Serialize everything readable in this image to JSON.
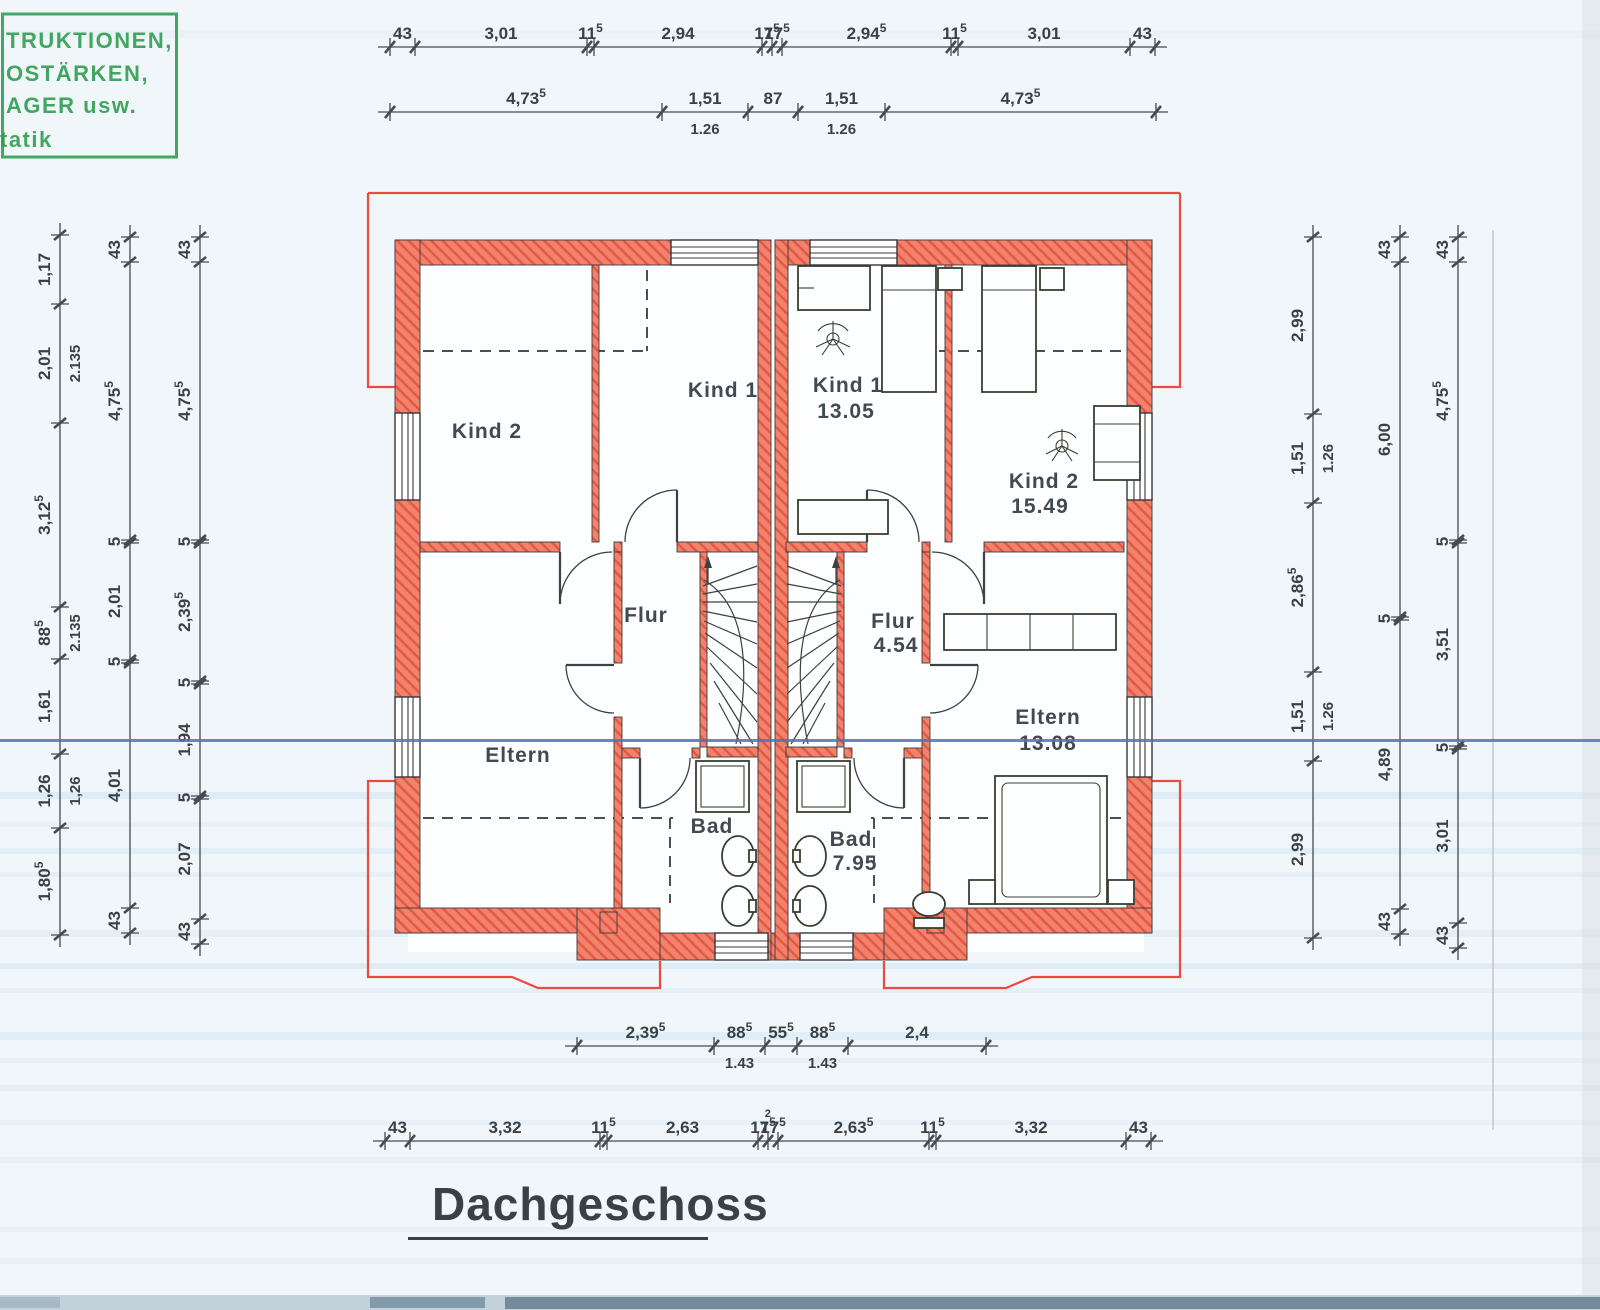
{
  "title": {
    "text": "Dachgeschoss"
  },
  "stamp": {
    "color": "#2f9e50",
    "lines": [
      "TRUKTIONEN,",
      "OSTÄRKEN,",
      "AGER usw.",
      "tatik"
    ]
  },
  "rooms": {
    "left": {
      "kind2": "Kind 2",
      "kind1": "Kind 1",
      "flur": "Flur",
      "eltern": "Eltern",
      "bad": "Bad"
    },
    "right": {
      "kind1": "Kind 1",
      "kind1_area": "13.05",
      "kind2": "Kind 2",
      "kind2_area": "15.49",
      "flur": "Flur",
      "flur_area": "4.54",
      "eltern": "Eltern",
      "eltern_area": "13.08",
      "bad": "Bad",
      "bad_area": "7.95"
    }
  },
  "dimensions": {
    "chains": [
      {
        "id": "top-upper",
        "dir": "h",
        "x": 390,
        "y": 47,
        "segments": [
          {
            "len": 25,
            "t": "43"
          },
          {
            "len": 172,
            "t": "3,01"
          },
          {
            "len": 7,
            "t": "11",
            "sup": "5"
          },
          {
            "len": 168,
            "t": "2,94"
          },
          {
            "len": 10,
            "t": "17",
            "sup": "5"
          },
          {
            "len": 10,
            "t": "17",
            "sup": "5"
          },
          {
            "len": 169,
            "t": "2,94",
            "sup": "5"
          },
          {
            "len": 7,
            "t": "11",
            "sup": "5"
          },
          {
            "len": 172,
            "t": "3,01"
          },
          {
            "len": 25,
            "t": "43"
          }
        ]
      },
      {
        "id": "top-lower",
        "dir": "h",
        "x": 390,
        "y": 112,
        "segments": [
          {
            "len": 272,
            "t": "4,73",
            "sup": "5"
          },
          {
            "len": 86,
            "t": "1,51",
            "sub": "1.26"
          },
          {
            "len": 50,
            "t": "87"
          },
          {
            "len": 87,
            "t": "1,51",
            "sub": "1.26"
          },
          {
            "len": 271,
            "t": "4,73",
            "sup": "5"
          }
        ]
      },
      {
        "id": "bottom-upper",
        "dir": "h",
        "x": 577,
        "y": 1046,
        "segments": [
          {
            "len": 137,
            "t": "2,39",
            "sup": "5"
          },
          {
            "len": 51,
            "t": "88",
            "sup": "5",
            "sub": "1.43"
          },
          {
            "len": 32,
            "t": "55",
            "sup": "5"
          },
          {
            "len": 51,
            "t": "88",
            "sup": "5",
            "sub": "1.43"
          },
          {
            "len": 138,
            "t": "2,4"
          }
        ]
      },
      {
        "id": "bottom-lower",
        "dir": "h",
        "x": 385,
        "y": 1141,
        "segments": [
          {
            "len": 25,
            "t": "43"
          },
          {
            "len": 190,
            "t": "3,32"
          },
          {
            "len": 7,
            "t": "11",
            "sup": "5"
          },
          {
            "len": 151,
            "t": "2,63"
          },
          {
            "len": 10,
            "t": "17",
            "sup": "5",
            "sup2": "2"
          },
          {
            "len": 10,
            "t": "17",
            "sup": "5"
          },
          {
            "len": 151,
            "t": "2,63",
            "sup": "5"
          },
          {
            "len": 7,
            "t": "11",
            "sup": "5"
          },
          {
            "len": 190,
            "t": "3,32"
          },
          {
            "len": 25,
            "t": "43"
          }
        ]
      },
      {
        "id": "left-outer",
        "dir": "v",
        "x": 60,
        "y": 235,
        "segments": [
          {
            "len": 69,
            "t": "1,17"
          },
          {
            "len": 119,
            "t": "2,01",
            "sub": "2.135"
          },
          {
            "len": 184,
            "t": "3,12",
            "sup": "5"
          },
          {
            "len": 52,
            "t": "88",
            "sup": "5",
            "sub": "2.135"
          },
          {
            "len": 95,
            "t": "1,61"
          },
          {
            "len": 74,
            "t": "1,26",
            "sub": "1,26"
          },
          {
            "len": 107,
            "t": "1,80",
            "sup": "5"
          }
        ]
      },
      {
        "id": "left-mid",
        "dir": "v",
        "x": 130,
        "y": 237,
        "segments": [
          {
            "len": 25,
            "t": "43"
          },
          {
            "len": 278,
            "t": "4,75",
            "sup": "5"
          },
          {
            "len": 3,
            "t": "5"
          },
          {
            "len": 117,
            "t": "2,01"
          },
          {
            "len": 3,
            "t": "5"
          },
          {
            "len": 245,
            "t": "4,01"
          },
          {
            "len": 25,
            "t": "43"
          }
        ]
      },
      {
        "id": "left-inner",
        "dir": "v",
        "x": 200,
        "y": 237,
        "segments": [
          {
            "len": 25,
            "t": "43"
          },
          {
            "len": 278,
            "t": "4,75",
            "sup": "5"
          },
          {
            "len": 3,
            "t": "5"
          },
          {
            "len": 138,
            "t": "2,39",
            "sup": "5"
          },
          {
            "len": 3,
            "t": "5"
          },
          {
            "len": 112,
            "t": "1,94"
          },
          {
            "len": 3,
            "t": "5"
          },
          {
            "len": 120,
            "t": "2,07"
          },
          {
            "len": 25,
            "t": "43"
          }
        ]
      },
      {
        "id": "right-inner",
        "dir": "v",
        "x": 1313,
        "y": 237,
        "segments": [
          {
            "len": 177,
            "t": "2,99"
          },
          {
            "len": 89,
            "t": "1,51",
            "sub": "1.26"
          },
          {
            "len": 169,
            "t": "2,86",
            "sup": "5"
          },
          {
            "len": 89,
            "t": "1,51",
            "sub": "1.26"
          },
          {
            "len": 177,
            "t": "2,99"
          }
        ]
      },
      {
        "id": "right-mid",
        "dir": "v",
        "x": 1400,
        "y": 237,
        "segments": [
          {
            "len": 25,
            "t": "43"
          },
          {
            "len": 355,
            "t": "6,00"
          },
          {
            "len": 3,
            "t": "5"
          },
          {
            "len": 289,
            "t": "4,89"
          },
          {
            "len": 25,
            "t": "43"
          }
        ]
      },
      {
        "id": "right-outer",
        "dir": "v",
        "x": 1458,
        "y": 237,
        "segments": [
          {
            "len": 25,
            "t": "43"
          },
          {
            "len": 278,
            "t": "4,75",
            "sup": "5"
          },
          {
            "len": 3,
            "t": "5"
          },
          {
            "len": 203,
            "t": "3,51"
          },
          {
            "len": 3,
            "t": "5"
          },
          {
            "len": 174,
            "t": "3,01"
          },
          {
            "len": 25,
            "t": "43"
          }
        ]
      }
    ]
  }
}
